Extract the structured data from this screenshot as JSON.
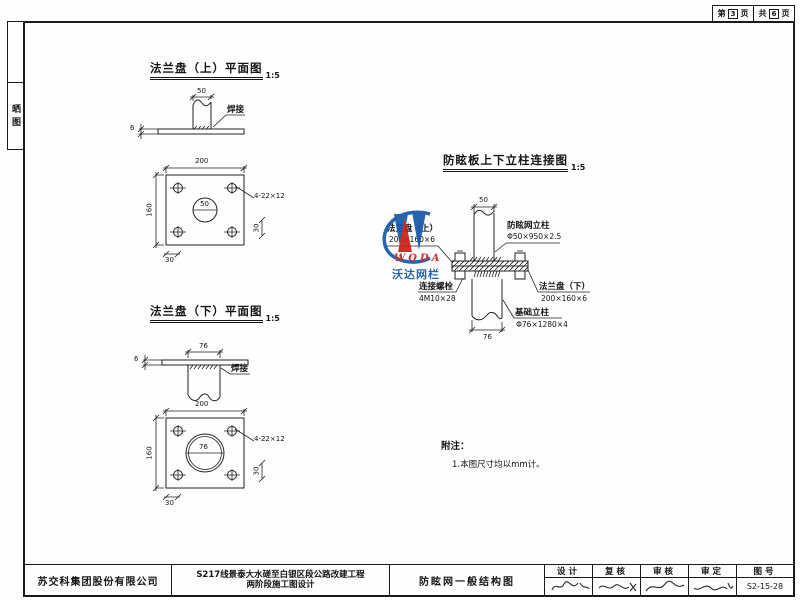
{
  "page_header": {
    "page_prefix": "第",
    "page_number": "3",
    "page_suffix": "页",
    "total_prefix": "共",
    "total_number": "6",
    "total_suffix": "页"
  },
  "margin_stamp": {
    "text": "晒图"
  },
  "flange_top": {
    "title": "法兰盘（上）平面图",
    "scale": "1:5",
    "section": {
      "top_dim": "50",
      "thickness_dim": "6",
      "weld_label": "焊接"
    },
    "plan": {
      "width_dim": "200",
      "height_dim": "160",
      "hole_dim": "50",
      "holes_label": "4-22×12",
      "edge_dim_h": "30",
      "edge_dim_v": "30"
    }
  },
  "flange_bottom": {
    "title": "法兰盘（下）平面图",
    "scale": "1:5",
    "section": {
      "top_dim": "76",
      "thickness_dim": "6",
      "weld_label": "焊接"
    },
    "plan": {
      "width_dim": "200",
      "height_dim": "160",
      "hole_dim": "76",
      "holes_label": "4-22×12",
      "edge_dim_h": "30",
      "edge_dim_v": "30"
    }
  },
  "connection": {
    "title": "防眩板上下立柱连接图",
    "scale": "1:5",
    "top_dim": "50",
    "bottom_dim": "76",
    "post_label": "防眩网立柱",
    "post_spec": "Φ50×950×2.5",
    "flange_top_label": "法兰盘（上）",
    "flange_top_spec": "200×160×6",
    "bolt_label": "连接螺栓",
    "bolt_spec": "4M10×28",
    "flange_bottom_label": "法兰盘（下）",
    "flange_bottom_spec": "200×160×6",
    "foundation_label": "基础立柱",
    "foundation_spec": "Φ76×1280×4"
  },
  "watermark": {
    "brand_en": "WODA",
    "brand_cn": "沃达网栏",
    "blue": "#1457a8",
    "red": "#cc2017"
  },
  "notes": {
    "heading": "附注：",
    "item1": "1.本图尺寸均以mm计。"
  },
  "title_block": {
    "company": "苏交科集团股份有限公司",
    "project_line1": "S217线景泰大水磋至白银区段公路改建工程",
    "project_line2": "两阶段施工图设计",
    "drawing_name": "防眩网一般结构图",
    "col_design": "设计",
    "col_check": "复核",
    "col_review": "审核",
    "col_approve": "审定",
    "col_number": "图号",
    "drawing_number": "S2-15-28"
  }
}
